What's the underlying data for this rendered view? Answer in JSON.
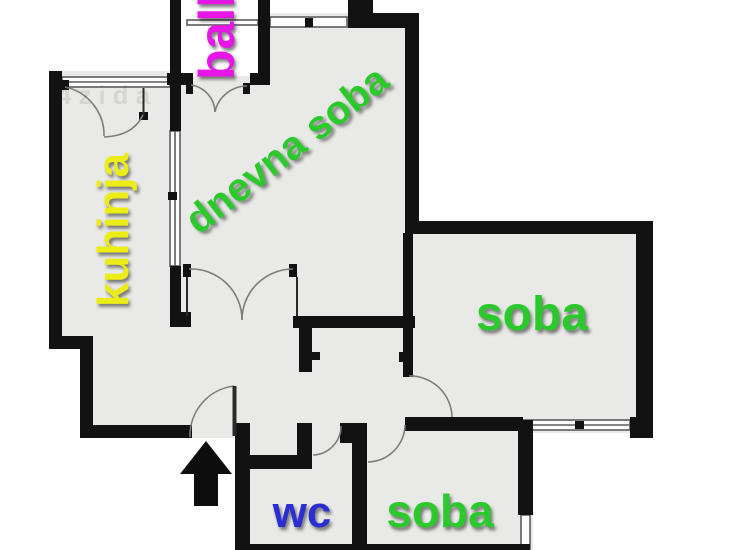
{
  "watermark": "4zida",
  "colors": {
    "wall": "#121212",
    "floor": "#e9e9e7",
    "outside": "#ffffff",
    "thin_line": "#7d7d7d",
    "green": "#2cc92c",
    "yellow": "#ecec17",
    "magenta": "#e616e6",
    "blue": "#2b2fd2"
  },
  "rooms": [
    {
      "id": "balcony",
      "label": "balk",
      "color": "#e616e6"
    },
    {
      "id": "kitchen",
      "label": "kuhinja",
      "color": "#ecec17"
    },
    {
      "id": "living-room",
      "label": "dnevna soba",
      "color": "#2cc92c"
    },
    {
      "id": "bedroom-right",
      "label": "soba",
      "color": "#2cc92c"
    },
    {
      "id": "wc",
      "label": "wc",
      "color": "#2b2fd2"
    },
    {
      "id": "bedroom-bottom",
      "label": "soba",
      "color": "#2cc92c"
    }
  ]
}
